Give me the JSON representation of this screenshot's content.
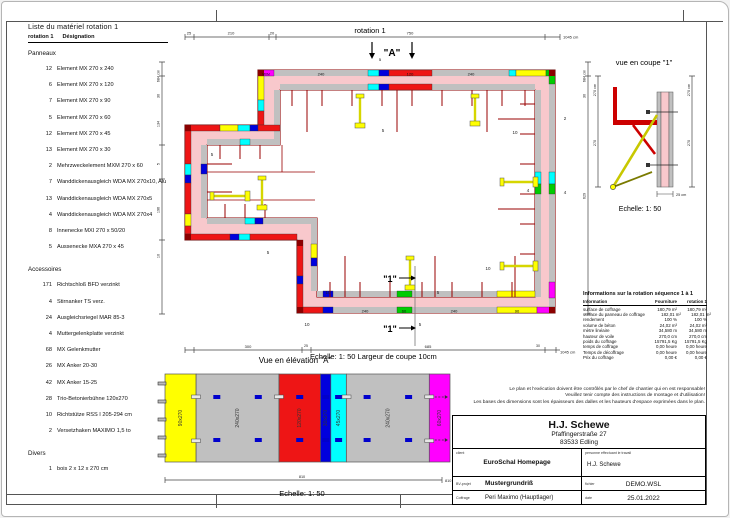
{
  "palette": {
    "wall_pink": "#f8c8cc",
    "formwork_gray": "#c0c0c0",
    "element_red": "#ee1515",
    "element_yellow": "#ffff00",
    "element_cyan": "#00ffff",
    "element_blue": "#0000dd",
    "element_magenta": "#ff00ff",
    "element_green": "#00cc00",
    "outline_darkred": "#8b0000",
    "clamp_blue": "#0000cc"
  },
  "material_list": {
    "title": "Liste du matériel  rotation 1",
    "col_qty": "rotation 1",
    "col_name": "Désignation",
    "sections": [
      {
        "name": "Panneaux",
        "items": [
          {
            "qty": "12",
            "label": "Element MX 270 x 240"
          },
          {
            "qty": "6",
            "label": "Element MX 270 x 120"
          },
          {
            "qty": "7",
            "label": "Element MX 270 x 90"
          },
          {
            "qty": "5",
            "label": "Element MX 270 x 60"
          },
          {
            "qty": "12",
            "label": "Element MX 270 x 45"
          },
          {
            "qty": "13",
            "label": "Element MX 270 x 30"
          },
          {
            "qty": "2",
            "label": "Mehrzweckelement MXM 270 x 60"
          },
          {
            "qty": "7",
            "label": "Wanddickenausgleich WDA MX 270x10, Alu"
          },
          {
            "qty": "13",
            "label": "Wanddickenausgleich WDA MX 270x5"
          },
          {
            "qty": "4",
            "label": "Wanddickenausgleich WDA MX 270x4"
          },
          {
            "qty": "8",
            "label": "Innenecke MXI 270 x 50/20"
          },
          {
            "qty": "5",
            "label": "Aussenecke MXA 270 x 45"
          }
        ]
      },
      {
        "name": "Accessoires",
        "items": [
          {
            "qty": "171",
            "label": "Richtschloß BFD verzinkt"
          },
          {
            "qty": "4",
            "label": "Stirnanker TS verz."
          },
          {
            "qty": "24",
            "label": "Ausgleichsriegel MAR 85-3"
          },
          {
            "qty": "4",
            "label": "Muttergelenkplatte verzinkt"
          },
          {
            "qty": "68",
            "label": "MX Gelenkmutter"
          },
          {
            "qty": "26",
            "label": "MX Anker 20-30"
          },
          {
            "qty": "42",
            "label": "MX Anker 15-25"
          },
          {
            "qty": "28",
            "label": "Trio-Betonierbühne 120x270"
          },
          {
            "qty": "10",
            "label": "Richtstütze RSS I  205-294 cm"
          },
          {
            "qty": "2",
            "label": "Versetzhaken MAXIMO 1,5 to"
          }
        ]
      },
      {
        "name": "Divers",
        "items": [
          {
            "qty": "1",
            "label": "bois 2 x 12 x 270 cm"
          }
        ]
      }
    ]
  },
  "plan": {
    "title": "rotation 1",
    "scale_note": "Echelle: 1: 50   Largeur de coupe 10cm",
    "section_marker": "\"A\"",
    "cut_marker": "\"1\"",
    "marker_small": "5",
    "top_dims": [
      "25",
      "210",
      "20",
      "750",
      "1045 cm"
    ],
    "bottom_dims": [
      "300",
      "25",
      "685",
      "30",
      "1045 cm"
    ],
    "left_dims": [
      "684 cm",
      "30",
      "134",
      "5",
      "196",
      "10"
    ],
    "right_dims": [
      "684 cm",
      "30",
      "629"
    ],
    "seg_labels": {
      "mxm": "MXM",
      "s240": "240",
      "s120": "120",
      "s60": "60",
      "s90": "90"
    },
    "floats": [
      "5",
      "10",
      "2",
      "4",
      "4",
      "5",
      "10",
      "5",
      "10",
      "10",
      "5",
      "5"
    ]
  },
  "coupe": {
    "title": "vue en coupe \"1\"",
    "scale": "Echelle: 1: 50",
    "dim_side": "270 cm",
    "dim_inner": "270",
    "dim_width": "25 cm"
  },
  "elevation": {
    "title": "Vue en élévation \"A\"",
    "scale": "Echelle: 1: 50",
    "total_dim": "810",
    "total_dim_unit": "810 cm",
    "panels": [
      {
        "label": "90x270",
        "w": 90,
        "color": "#ffff00"
      },
      {
        "label": "240x270",
        "w": 240,
        "color": "#c0c0c0"
      },
      {
        "label": "120x270",
        "w": 120,
        "color": "#ee1515"
      },
      {
        "label": "30x270",
        "w": 30,
        "color": "#0000dd"
      },
      {
        "label": "45x270",
        "w": 45,
        "color": "#00ffff"
      },
      {
        "label": "240x270",
        "w": 240,
        "color": "#c0c0c0"
      },
      {
        "label": "60x270",
        "w": 60,
        "color": "#ff00ff"
      }
    ]
  },
  "info_table": {
    "title": "Informations sur la rotation  séquence 1 à 1",
    "columns": [
      "Information",
      "Fourniture",
      "rotation 1"
    ],
    "rows": [
      [
        "surface de coffrage",
        "180,79 m²",
        "180,79 m²"
      ],
      [
        "surface du panneau de coffrage",
        "182,01 m²",
        "182,01 m²"
      ],
      [
        "rendement",
        "100 %",
        "100 %"
      ],
      [
        "volume de béton",
        "24,02 m³",
        "24,02 m³"
      ],
      [
        "mètre linéaire",
        "34,580 m",
        "34,580 m"
      ],
      [
        "hauteur de voile",
        "270,0 cm",
        "270,0 cm"
      ],
      [
        "poids du coffrage",
        "15791,5 Kg",
        "15791,5 Kg"
      ],
      [
        "temps de coffrage",
        "0,00 heure",
        "0,00 heure"
      ],
      [
        "Temps de décoffrage",
        "0,00 heure",
        "0,00 heure"
      ],
      [
        "Prix du coffrage",
        "0,00 €",
        "0,00 €"
      ]
    ]
  },
  "disclaimer_lines": [
    "Le plan et l'exécution doivent être contrôlés par le chef de chantier qui en est responsable!",
    "Veuillez tenir compte des instructions de montage et d'utilisation!",
    "Les bases des dimensions sont les épaisseurs des dalles et les hauteurs d'espace exprimées dans le plan."
  ],
  "title_block": {
    "company": "H.J. Schewe",
    "address_line1": "Pfaffingerstraße 27",
    "address_line2": "83533 Edling",
    "client_label": "client",
    "client_value": "EuroSchal Homepage",
    "worker_label": "personne effectuant le travail",
    "worker_value": "H.J. Schewe",
    "project_label": "BV-projet",
    "project_value": "Mustergrundriß",
    "coffrage_label": "Coffrage",
    "coffrage_value": "Peri Maximo (Hauptlager)",
    "file_label": "fichier",
    "file_value": "DEMO.WSL",
    "date_label": "date",
    "date_value": "25.01.2022"
  }
}
